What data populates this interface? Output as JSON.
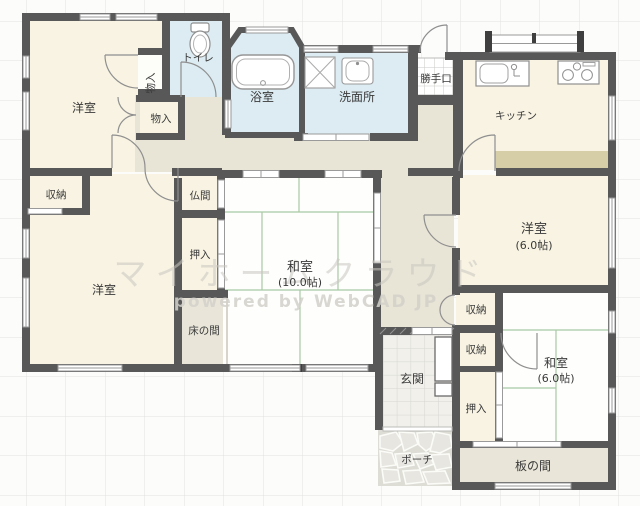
{
  "watermark": {
    "line1": "マイホームクラウド",
    "line2": "powered by WebCAD JP"
  },
  "labels": {
    "yoshitsu_tl": "洋室",
    "monoire_tate": "物入",
    "monoire": "物入",
    "toilet": "トイレ",
    "bath": "浴室",
    "senmenjo": "洗面所",
    "katteguchi": "勝手口",
    "kitchen": "キッチン",
    "shuno_l": "収納",
    "yoshitsu_bl": "洋室",
    "butsuma": "仏間",
    "oshiire_l": "押入",
    "tokonoma": "床の間",
    "washitsu10": "和室",
    "washitsu10_size": "(10.0帖)",
    "yoshitsu_r": "洋室",
    "yoshitsu_r_size": "(6.0帖)",
    "shuno_r1": "収納",
    "shuno_r2": "収納",
    "oshiire_r": "押入",
    "washitsu6": "和室",
    "washitsu6_size": "(6.0帖)",
    "genkan": "玄関",
    "porch": "ポーチ",
    "itanoma": "板の間"
  },
  "colors": {
    "wall": "#585858",
    "room_cream": "#f8f3e2",
    "hall_beige": "#e8e4d6",
    "water_blue": "#dcecf2",
    "tatami_white": "#fefefd",
    "tatami_line": "#a9c9a4",
    "counter_tan": "#d6cea6",
    "wood_floor": "#e9e6d9",
    "paper_grid": "#e2e2e1",
    "genkan_tile": "#f1f0eb",
    "porch_stone": "#e7e6e0"
  }
}
